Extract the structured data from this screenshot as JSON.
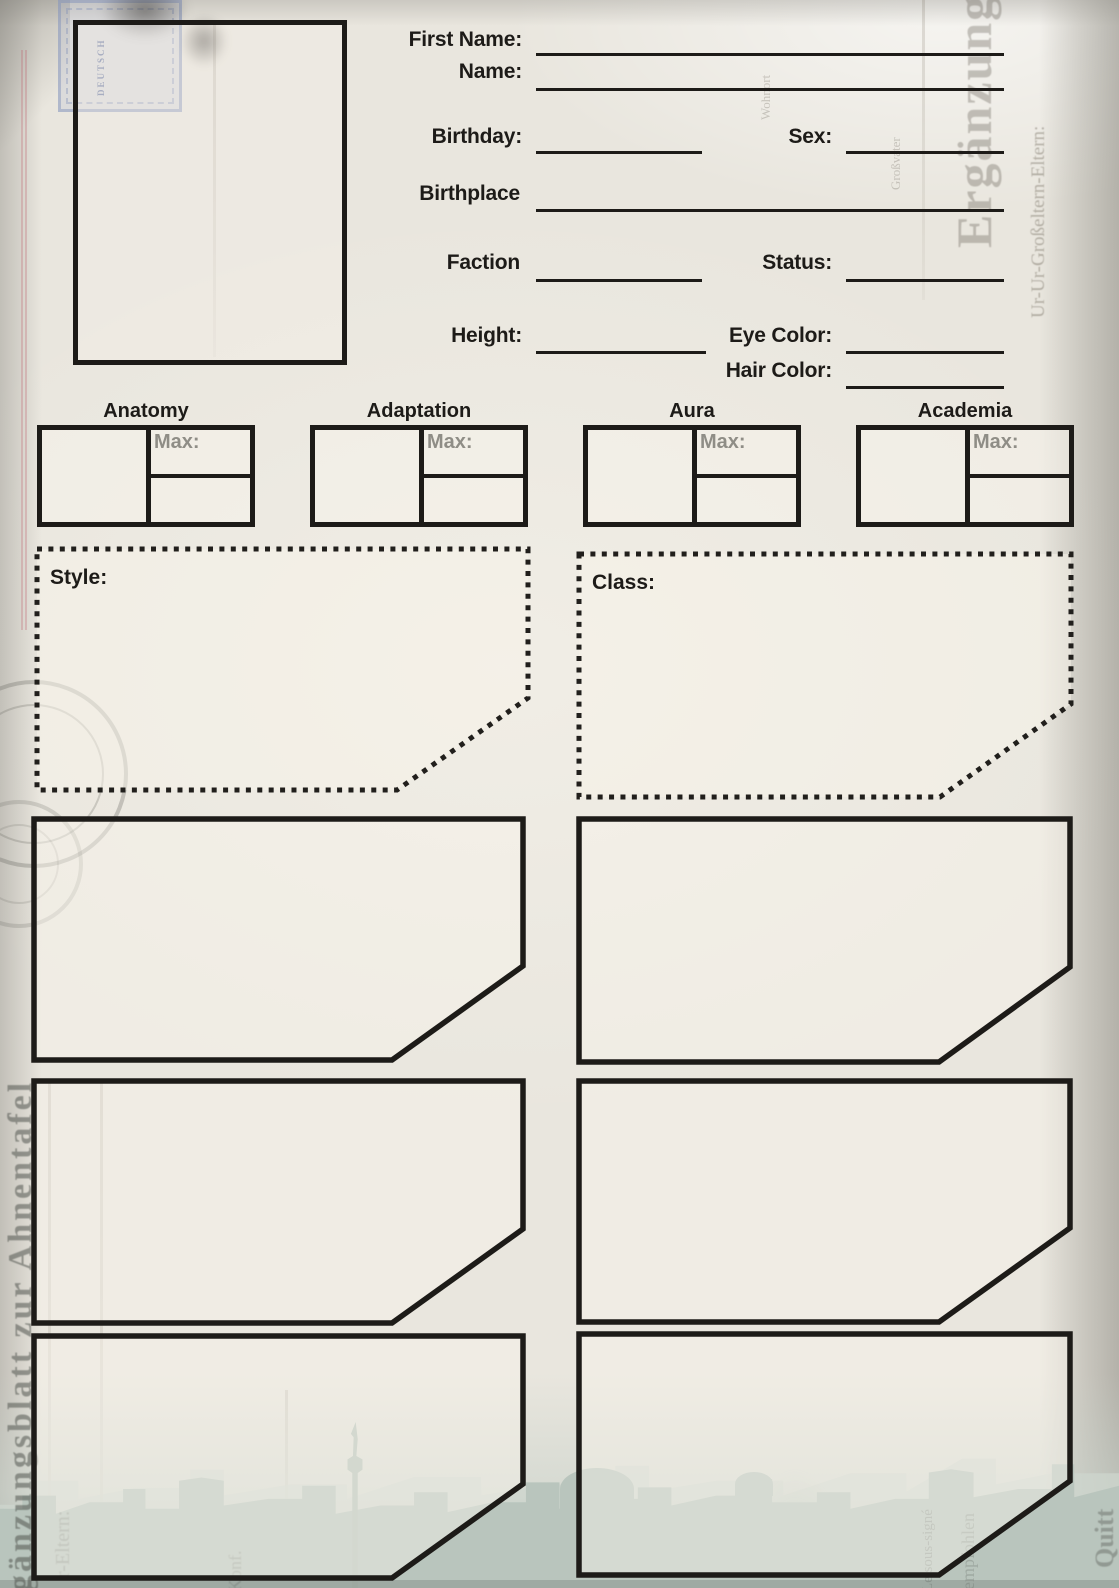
{
  "form": {
    "first_name": {
      "label": "First Name:"
    },
    "name": {
      "label": "Name:"
    },
    "birthday": {
      "label": "Birthday:"
    },
    "sex": {
      "label": "Sex:"
    },
    "birthplace": {
      "label": "Birthplace"
    },
    "faction": {
      "label": "Faction"
    },
    "status": {
      "label": "Status:"
    },
    "height": {
      "label": "Height:"
    },
    "eye_color": {
      "label": "Eye Color:"
    },
    "hair_color": {
      "label": "Hair Color:"
    }
  },
  "stats": {
    "max_label": "Max:",
    "items": [
      {
        "label": "Anatomy"
      },
      {
        "label": "Adaptation"
      },
      {
        "label": "Aura"
      },
      {
        "label": "Academia"
      }
    ]
  },
  "sections": {
    "style_label": "Style:",
    "class_label": "Class:"
  },
  "background_texts": {
    "left_margin": "gänzungsblatt zur Ahnentafel",
    "right_big": "Ergänzung",
    "right_margin_top": "Ur-Ur-Großeltern-Eltern:",
    "inner_faint_1": "r-Eltern:",
    "inner_faint_2": "Konf.",
    "bottom_right_1": "Le sous-signé",
    "bottom_right_2": "empfohlen",
    "bottom_right_3": "Quitt",
    "top_faint_1": "Wohnort",
    "top_faint_2": "Großvater",
    "stamp_text": "DEUTSCH"
  },
  "colors": {
    "ink": "#1d1b18",
    "paper": "#e9e6de",
    "box_fill": "#f4f0e6",
    "muted_label": "#8f8d86",
    "skyline": "#b9c5bd",
    "stamp_blue": "#9fb0cf"
  }
}
